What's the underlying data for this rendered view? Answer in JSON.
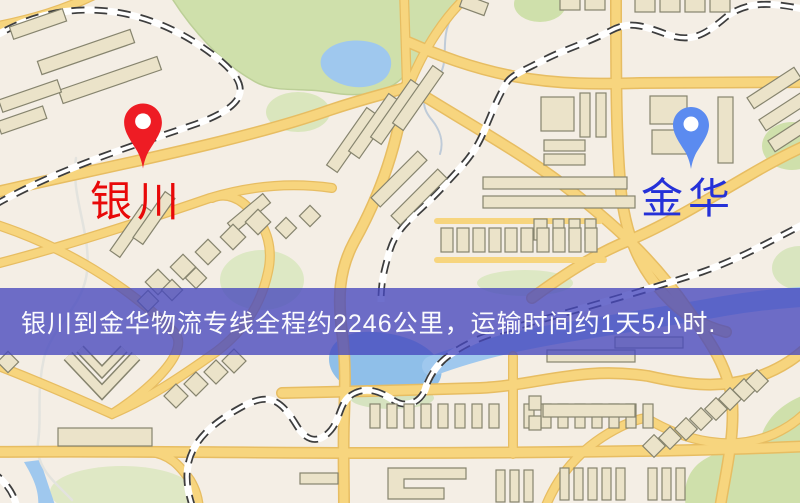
{
  "map": {
    "origin": {
      "label": "银川",
      "marker_color": "#ee1c24",
      "label_color": "#e80909"
    },
    "destination": {
      "label": "金华",
      "marker_color": "#5b8bf0",
      "label_color": "#2531d8"
    },
    "banner": {
      "text": "银川到金华物流专线全程约2246公里，运输时间约1天5小时.",
      "background": "#4a48c0",
      "text_color": "#fbfbfd",
      "distance_km": "2246",
      "duration": "1天5小时"
    },
    "palette": {
      "land": "#f4eee5",
      "road": "#f7d57e",
      "road_casing": "#e7bd62",
      "water": "#9fc8ee",
      "park": "#cfe0ab",
      "building": "#ebe3c9",
      "building_outline": "#86846e",
      "railway": "#3d3d3d"
    }
  }
}
